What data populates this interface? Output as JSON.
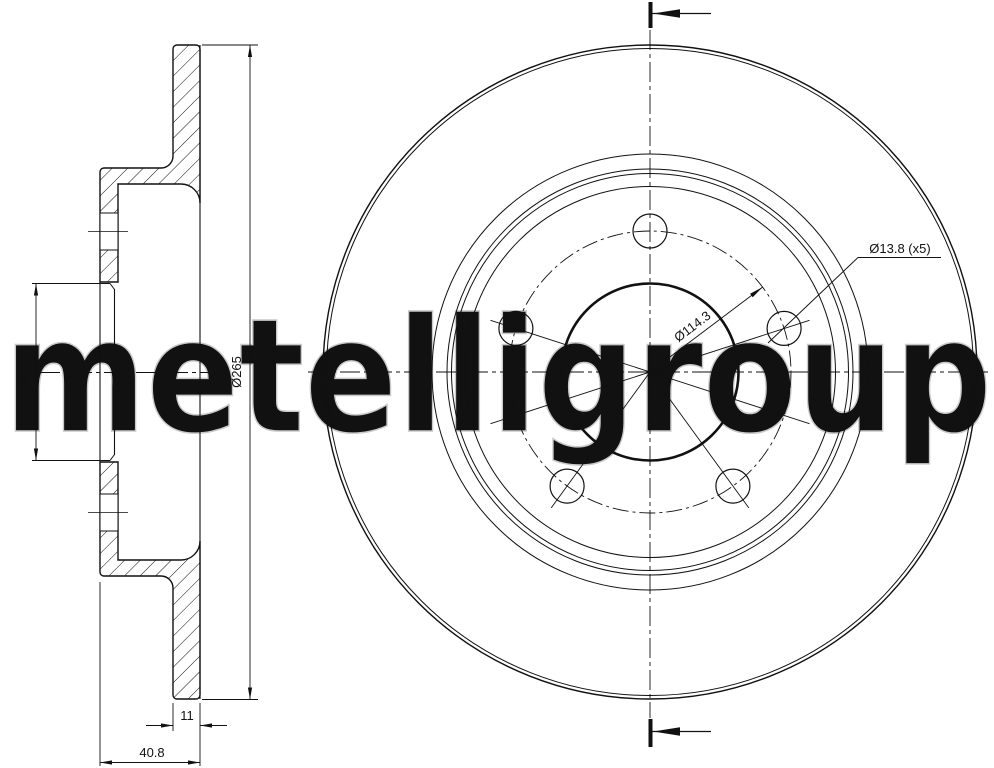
{
  "title": "Brake disc technical drawing",
  "watermark": "metelligroup",
  "colors": {
    "line": "#111111",
    "watermark_stroke": "#c9c9c9",
    "background": "#ffffff"
  },
  "views": {
    "section": {
      "dim_bore": "Ø72",
      "dim_outer": "Ø265",
      "dim_thickness": "11",
      "dim_overall_width": "40.8"
    },
    "front": {
      "dim_bolt_holes": "Ø13.8 (x5)",
      "dim_pitch_circle": "Ø114.3"
    }
  }
}
